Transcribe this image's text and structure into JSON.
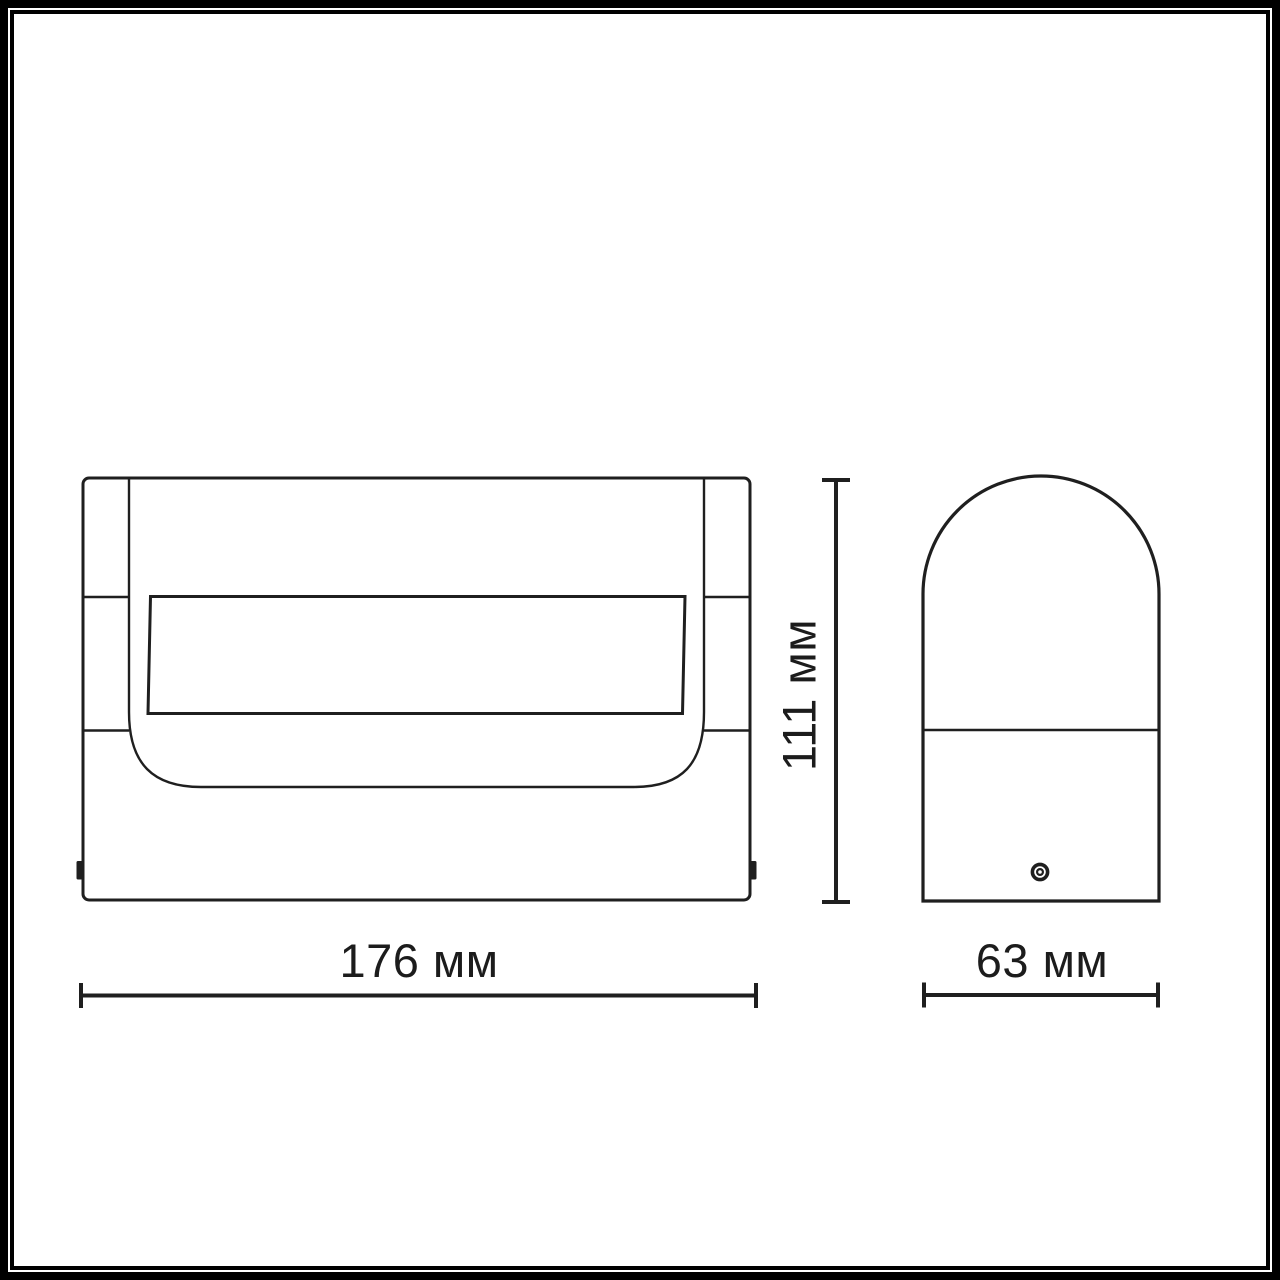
{
  "meta": {
    "background_color": "#ffffff",
    "frame_color": "#000000",
    "line_color": "#1f1f1f"
  },
  "diagram": {
    "type": "technical-dimension-drawing",
    "views": {
      "front": {
        "name": "front view of wall lamp"
      },
      "side": {
        "name": "side view of wall lamp"
      }
    },
    "dimensions": {
      "width": {
        "label": "176 мм",
        "value": 176,
        "unit": "мм"
      },
      "height": {
        "label": "111 мм",
        "value": 111,
        "unit": "мм"
      },
      "depth": {
        "label": "63 мм",
        "value": 63,
        "unit": "мм"
      }
    }
  }
}
